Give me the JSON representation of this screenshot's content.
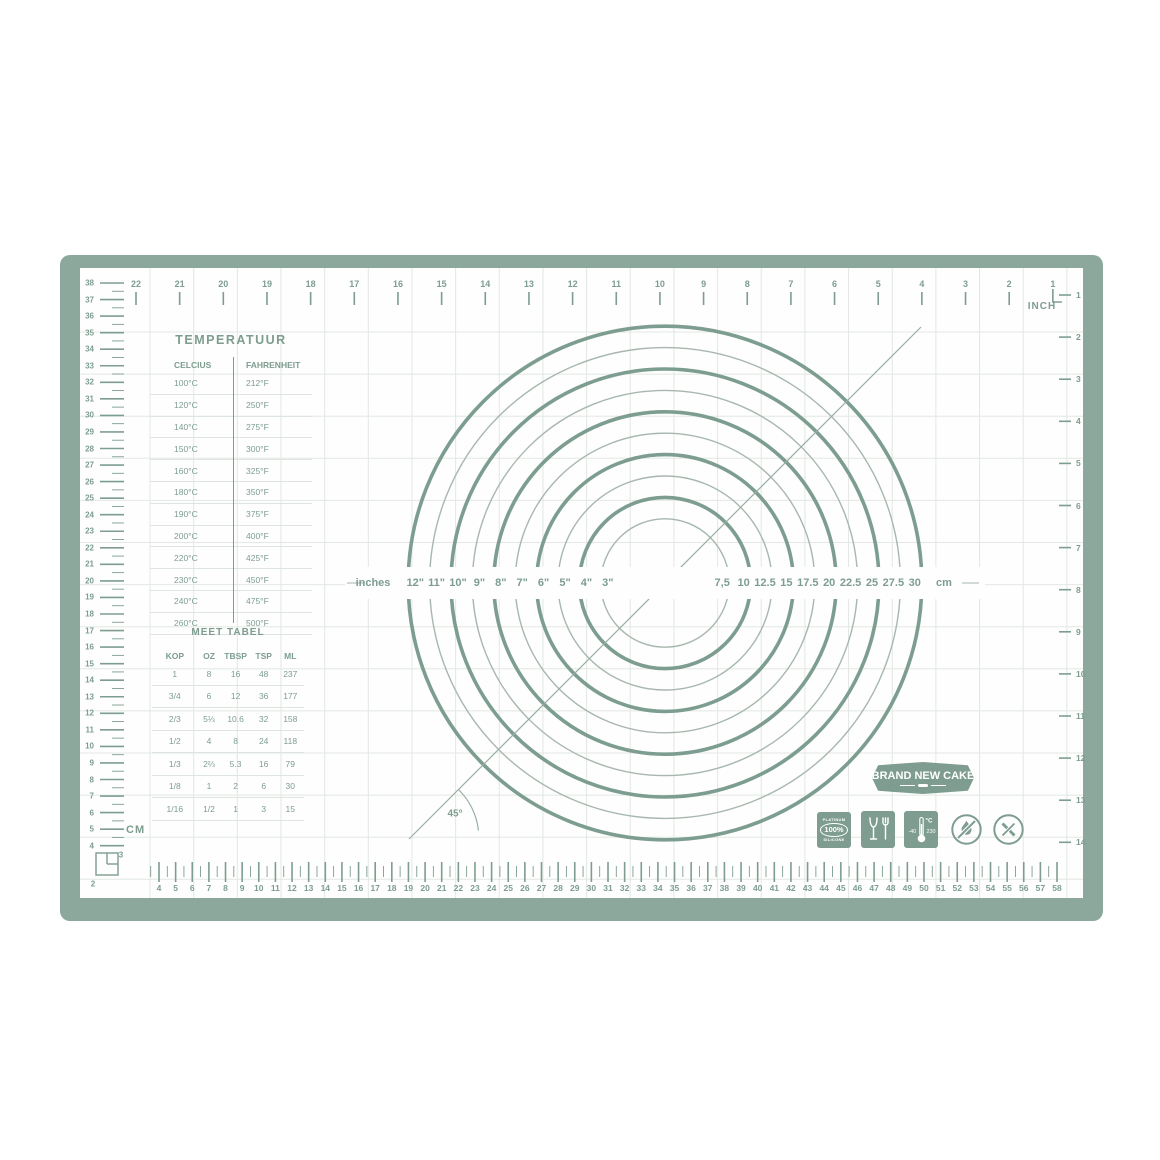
{
  "colors": {
    "frame": "#8CA79C",
    "accent": "#7E9D90",
    "circle_thick": "#7C9D8F",
    "circle_thin": "#A8B7AE",
    "grid": "#E3E8E4",
    "separator": "#DEE5E1",
    "line": "#9AAEA4",
    "mat": "#FDFEFD"
  },
  "rulers": {
    "top": {
      "unit_label": "INCH",
      "numbers": [
        22,
        21,
        20,
        19,
        18,
        17,
        16,
        15,
        14,
        13,
        12,
        11,
        10,
        9,
        8,
        7,
        6,
        5,
        4,
        3,
        2,
        1
      ]
    },
    "right": {
      "numbers": [
        1,
        2,
        3,
        4,
        5,
        6,
        7,
        8,
        9,
        10,
        11,
        12,
        13,
        14
      ]
    },
    "left": {
      "unit_label": "CM",
      "numbers": [
        38,
        37,
        36,
        35,
        34,
        33,
        32,
        31,
        30,
        29,
        28,
        27,
        26,
        25,
        24,
        23,
        22,
        21,
        20,
        19,
        18,
        17,
        16,
        15,
        14,
        13,
        12,
        11,
        10,
        9,
        8,
        7,
        6,
        5,
        4
      ],
      "corner_numbers": [
        "3",
        "2"
      ]
    },
    "bottom": {
      "numbers": [
        4,
        5,
        6,
        7,
        8,
        9,
        10,
        11,
        12,
        13,
        14,
        15,
        16,
        17,
        18,
        19,
        20,
        21,
        22,
        23,
        24,
        25,
        26,
        27,
        28,
        29,
        30,
        31,
        32,
        33,
        34,
        35,
        36,
        37,
        38,
        39,
        40,
        41,
        42,
        43,
        44,
        45,
        46,
        47,
        48,
        49,
        50,
        51,
        52,
        53,
        54,
        55,
        56,
        57,
        58
      ]
    }
  },
  "temperature_table": {
    "title": "TEMPERATUUR",
    "columns": [
      "CELCIUS",
      "FAHRENHEIT"
    ],
    "rows": [
      [
        "100°C",
        "212°F"
      ],
      [
        "120°C",
        "250°F"
      ],
      [
        "140°C",
        "275°F"
      ],
      [
        "150°C",
        "300°F"
      ],
      [
        "160°C",
        "325°F"
      ],
      [
        "180°C",
        "350°F"
      ],
      [
        "190°C",
        "375°F"
      ],
      [
        "200°C",
        "400°F"
      ],
      [
        "220°C",
        "425°F"
      ],
      [
        "230°C",
        "450°F"
      ],
      [
        "240°C",
        "475°F"
      ],
      [
        "260°C",
        "500°F"
      ]
    ]
  },
  "measure_table": {
    "title": "MEET TABEL",
    "columns": [
      "KOP",
      "OZ",
      "TBSP",
      "TSP",
      "ML"
    ],
    "rows": [
      [
        "1",
        "8",
        "16",
        "48",
        "237"
      ],
      [
        "3/4",
        "6",
        "12",
        "36",
        "177"
      ],
      [
        "2/3",
        "5⅓",
        "10.6",
        "32",
        "158"
      ],
      [
        "1/2",
        "4",
        "8",
        "24",
        "118"
      ],
      [
        "1/3",
        "2⅔",
        "5.3",
        "16",
        "79"
      ],
      [
        "1/8",
        "1",
        "2",
        "6",
        "30"
      ],
      [
        "1/16",
        "1/2",
        "1",
        "3",
        "15"
      ]
    ]
  },
  "circles": {
    "left_caption": "inches",
    "right_caption": "cm",
    "rings": [
      {
        "inch_label": "12\"",
        "cm_label": "30",
        "diameter_in": 12,
        "thick": true
      },
      {
        "inch_label": "11\"",
        "cm_label": "27.5",
        "diameter_in": 11,
        "thick": false
      },
      {
        "inch_label": "10\"",
        "cm_label": "25",
        "diameter_in": 10,
        "thick": true
      },
      {
        "inch_label": "9\"",
        "cm_label": "22.5",
        "diameter_in": 9,
        "thick": false
      },
      {
        "inch_label": "8\"",
        "cm_label": "20",
        "diameter_in": 8,
        "thick": true
      },
      {
        "inch_label": "7\"",
        "cm_label": "17.5",
        "diameter_in": 7,
        "thick": false
      },
      {
        "inch_label": "6\"",
        "cm_label": "15",
        "diameter_in": 6,
        "thick": true
      },
      {
        "inch_label": "5\"",
        "cm_label": "12.5",
        "diameter_in": 5,
        "thick": false
      },
      {
        "inch_label": "4\"",
        "cm_label": "10",
        "diameter_in": 4,
        "thick": true
      },
      {
        "inch_label": "3\"",
        "cm_label": "7,5",
        "diameter_in": 3,
        "thick": false
      }
    ]
  },
  "angle": {
    "label": "45°"
  },
  "logo": {
    "text": "BRAND NEW CAKE"
  },
  "icons": {
    "platinum": {
      "top": "PLATINUM",
      "value": "100%",
      "bottom": "SILICONE"
    },
    "temperature": {
      "unit": "°C",
      "min": "-40",
      "max": "230"
    }
  }
}
